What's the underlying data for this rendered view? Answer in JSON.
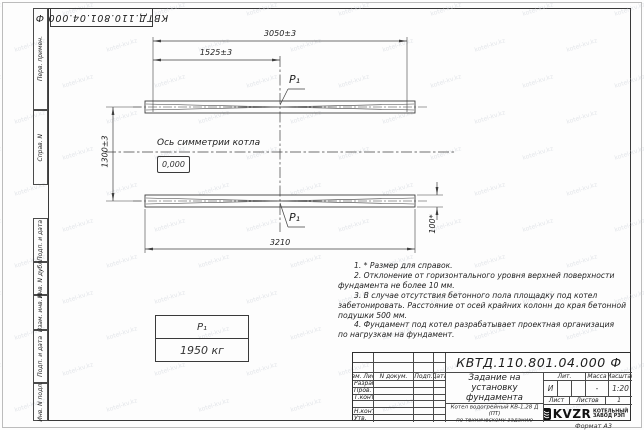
{
  "watermark": {
    "text": "kotel-kv.kz"
  },
  "corner_stamp": {
    "designation": "КВТД.110.801.04.000 Ф"
  },
  "margin": {
    "perv": "Перв. примен.",
    "sprav": "Справ. N",
    "podp1": "Подп. и дата",
    "inv_dubl": "Инв. N дубл.",
    "vzam": "Взам. инв. N",
    "podp2": "Подп. и дата",
    "inv_podl": "Инв. N подл."
  },
  "drawing": {
    "dim_3050": "3050±3",
    "dim_1525": "1525±3",
    "dim_1300": "1300±3",
    "dim_3210": "3210",
    "dim_100": "100*",
    "axis_label": "Ось симметрии котла",
    "level_mark": "0,000",
    "p1_top": "P₁",
    "p1_bottom": "P₁",
    "load_table": {
      "name": "P₁",
      "value": "1950 кг"
    }
  },
  "notes": {
    "lines": [
      "1. * Размер для справок.",
      "2. Отклонение от горизонтального уровня верхней поверхности",
      "фундамента не более 10 мм.",
      "3. В случае отсутствия бетонного пола площадку под котел",
      "забетонировать. Расстояние от осей крайних колонн до края бетонной",
      "подушки 500 мм.",
      "4. Фундамент под котел разрабатывает проектная организация",
      "по нагрузкам на фундамент."
    ]
  },
  "title_block": {
    "designation": "КВТД.110.801.04.000 Ф",
    "doc_title_lines": [
      "Задание на",
      "установку",
      "фундамента"
    ],
    "product_lines": [
      "Котел водогрейный КВ-1,28 Д (ПТ)",
      "по техническому заданию"
    ],
    "header_cols": [
      "Изм. Лист",
      "N докум.",
      "Подп.",
      "Дата"
    ],
    "rows": [
      "Разраб.",
      "Пров.",
      "Т.контр.",
      "",
      "Н.контр.",
      "Утв."
    ],
    "lit_label": "Лит.",
    "mass_label": "Масса",
    "scale_label": "Масштаб",
    "lit_value": "И",
    "mass_value": "-",
    "scale_value": "1:20",
    "sheet_label": "Лист",
    "sheets_label": "Листов",
    "sheets_value": "1",
    "company": {
      "logo": "KVZR",
      "name_line1": "КОТЕЛЬНЫЙ",
      "name_line2": "ЗАВОД РЭП"
    },
    "format": "Формат А3"
  }
}
